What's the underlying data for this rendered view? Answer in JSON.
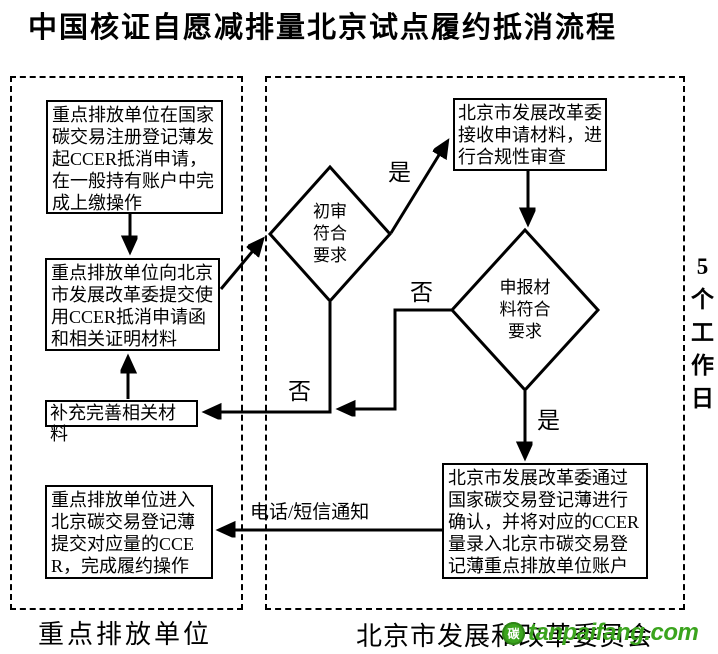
{
  "title": "中国核证自愿减排量北京试点履约抵消流程",
  "lanes": {
    "left_label": "重点排放单位",
    "right_label": "北京市发展和改革委员会"
  },
  "duration_note": "5个工作日",
  "nodes": {
    "b1": "重点排放单位在国家碳交易注册登记薄发起CCER抵消申请，在一般持有账户中完成上缴操作",
    "b2": "重点排放单位向北京市发展改革委提交使用CCER抵消申请函和相关证明材料",
    "b3": "补充完善相关材料",
    "b4": "重点排放单位进入北京碳交易登记薄提交对应量的CCER，完成履约操作",
    "b5": "北京市发展改革委接收申请材料，进行合规性审查",
    "b6": "北京市发展改革委通过国家碳交易登记薄进行确认，并将对应的CCER量录入北京市碳交易登记薄重点排放单位账户",
    "d1": "初审符合要求",
    "d2": "申报材料符合要求"
  },
  "edge_labels": {
    "d1_yes": "是",
    "d1_no": "否",
    "d2_yes": "是",
    "d2_no": "否",
    "notify": "电话/短信通知"
  },
  "watermark": {
    "logo_char": "碳",
    "text": "tanpaifang.com",
    "color": "#3ba41e"
  },
  "colors": {
    "line": "#000000",
    "background": "#ffffff"
  }
}
